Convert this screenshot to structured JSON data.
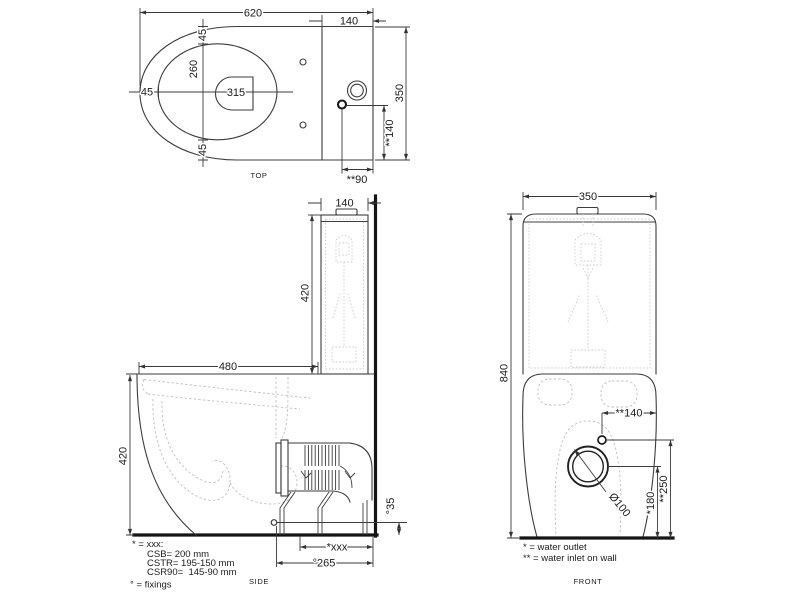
{
  "drawing": {
    "views": {
      "top": {
        "label": "TOP",
        "dims": {
          "total_depth": "620",
          "cistern_depth": "140",
          "seat_top": "45",
          "opening_width": "260",
          "valve": "315",
          "seat_left": "45",
          "seat_bottom": "45",
          "width": "350",
          "inlet_v": "**140",
          "inlet_h": "**90"
        }
      },
      "side": {
        "label": "SIDE",
        "dims": {
          "cistern_depth": "140",
          "cistern_height": "420",
          "seat_depth": "480",
          "bowl_height": "420",
          "outlet_floor": "°35",
          "outlet_dist": "*xxx",
          "fixing_dist": "°265"
        }
      },
      "front": {
        "label": "FRONT",
        "dims": {
          "width": "350",
          "total_height": "840",
          "inlet_offset": "**140",
          "outlet_diameter": "Ø100",
          "outlet_height": "*180",
          "inlet_height": "**250"
        }
      }
    },
    "legend_side": {
      "line1": "* = xxx:",
      "line2": "CSB= 200 mm",
      "line3": "CSTR= 195-150 mm",
      "line4": "CSR90=  145-90 mm",
      "line5": "° = fixings"
    },
    "legend_front": {
      "line1": "* = water outlet",
      "line2": "** = water inlet on wall"
    },
    "colors": {
      "line": "#3c3c3c",
      "heavy_line": "#151515",
      "hidden_line": "#bfbfbf",
      "background": "#ffffff"
    }
  }
}
